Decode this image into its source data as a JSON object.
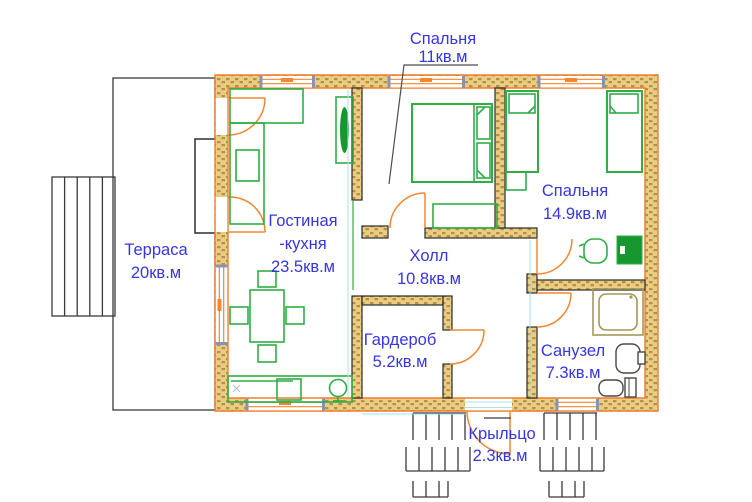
{
  "meta": {
    "type": "floor-plan",
    "language": "ru"
  },
  "colors": {
    "label": "#3636e2",
    "wall_fill": "#e9cd84",
    "wall_speckle": "#b98f42",
    "exterior_stroke": "#ee7d2f",
    "interior_stroke": "#2a2a2a",
    "furniture": "#2fae44",
    "furniture_dark": "#16982e",
    "door": "#f5862e",
    "window_jamb": "#8494b6",
    "outline": "#3a3a3a",
    "fixture": "#4a4a42",
    "shower": "#a5975a",
    "dimension": "#a6e3e4",
    "leader": "#4d4d4d",
    "background": "#ffffff"
  },
  "rooms": [
    {
      "id": "terrace",
      "name": "Терраса",
      "area": "20кв.м"
    },
    {
      "id": "living_kitchen",
      "name": "Гостиная",
      "name2": "-кухня",
      "area": "23.5кв.м"
    },
    {
      "id": "bedroom_top",
      "name": "Спальня",
      "area": "11кв.м"
    },
    {
      "id": "bedroom_right",
      "name": "Спальня",
      "area": "14.9кв.м"
    },
    {
      "id": "hall",
      "name": "Холл",
      "area": "10.8кв.м"
    },
    {
      "id": "wardrobe",
      "name": "Гардероб",
      "area": "5.2кв.м"
    },
    {
      "id": "bathroom",
      "name": "Санузел",
      "area": "7.3кв.м"
    },
    {
      "id": "porch",
      "name": "Крыльцо",
      "area": "2.3кв.м"
    }
  ]
}
